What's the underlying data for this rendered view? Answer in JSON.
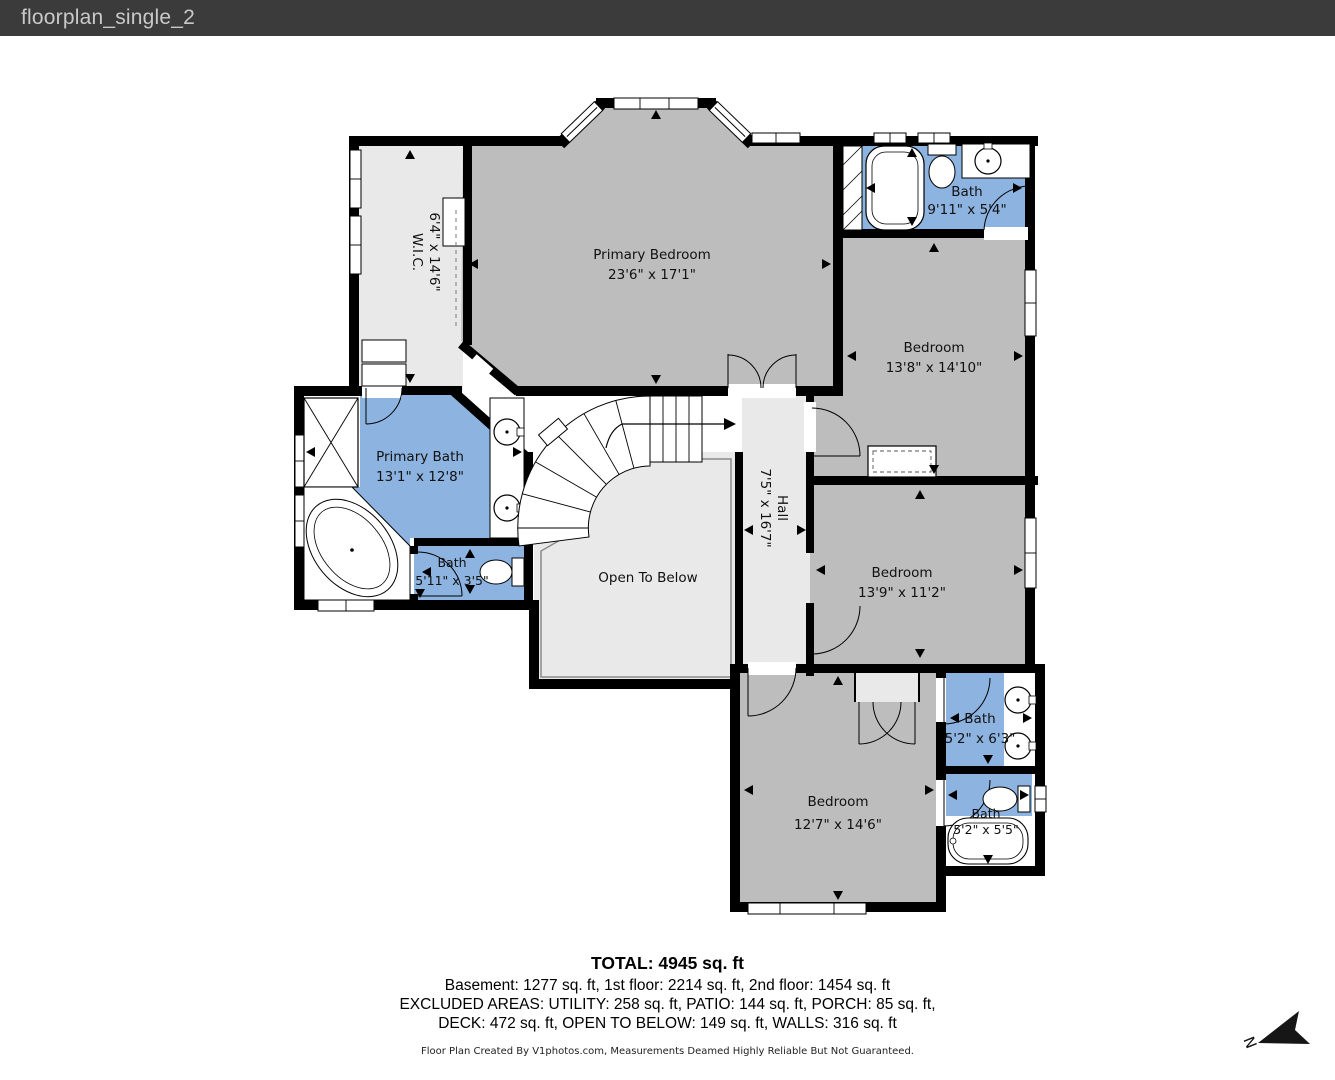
{
  "header": {
    "title": "floorplan_single_2"
  },
  "floorplan": {
    "rooms": {
      "wic": {
        "name": "W.I.C.",
        "dims": "6'4\" x 14'6\""
      },
      "primary_bedroom": {
        "name": "Primary Bedroom",
        "dims": "23'6\" x 17'1\""
      },
      "bath_top": {
        "name": "Bath",
        "dims": "9'11\" x 5'4\""
      },
      "bedroom_top_right": {
        "name": "Bedroom",
        "dims": "13'8\" x 14'10\""
      },
      "primary_bath": {
        "name": "Primary Bath",
        "dims": "13'1\" x 12'8\""
      },
      "bath_small": {
        "name": "Bath",
        "dims": "5'11\" x 3'5\""
      },
      "hall": {
        "name": "Hall",
        "dims": "7'5\" x 16'7\""
      },
      "open_to_below": {
        "name": "Open To Below"
      },
      "bedroom_mid_right": {
        "name": "Bedroom",
        "dims": "13'9\" x 11'2\""
      },
      "bath_mid_right": {
        "name": "Bath",
        "dims": "5'2\" x 6'3\""
      },
      "bedroom_bottom": {
        "name": "Bedroom",
        "dims": "12'7\" x 14'6\""
      },
      "bath_bottom_right": {
        "name": "Bath",
        "dims": "5'2\" x 5'5\""
      }
    },
    "summary": {
      "total": "TOTAL: 4945 sq. ft",
      "floors": "Basement: 1277 sq. ft, 1st floor: 2214 sq. ft, 2nd floor: 1454 sq. ft",
      "excluded1": "EXCLUDED AREAS: UTILITY: 258 sq. ft, PATIO: 144 sq. ft, PORCH: 85 sq. ft,",
      "excluded2": "DECK: 472 sq. ft, OPEN TO BELOW: 149 sq. ft, WALLS: 316 sq. ft",
      "disclaimer": "Floor Plan Created By V1photos.com, Measurements Deamed Highly Reliable But Not Guaranteed."
    },
    "compass": {
      "label": "N"
    },
    "colors": {
      "header_bg": "#3b3b3b",
      "wall": "#000000",
      "bedroom_fill": "#bdbdbd",
      "area_fill": "#e9e9e9",
      "bath_fill": "#8db3e0"
    }
  }
}
